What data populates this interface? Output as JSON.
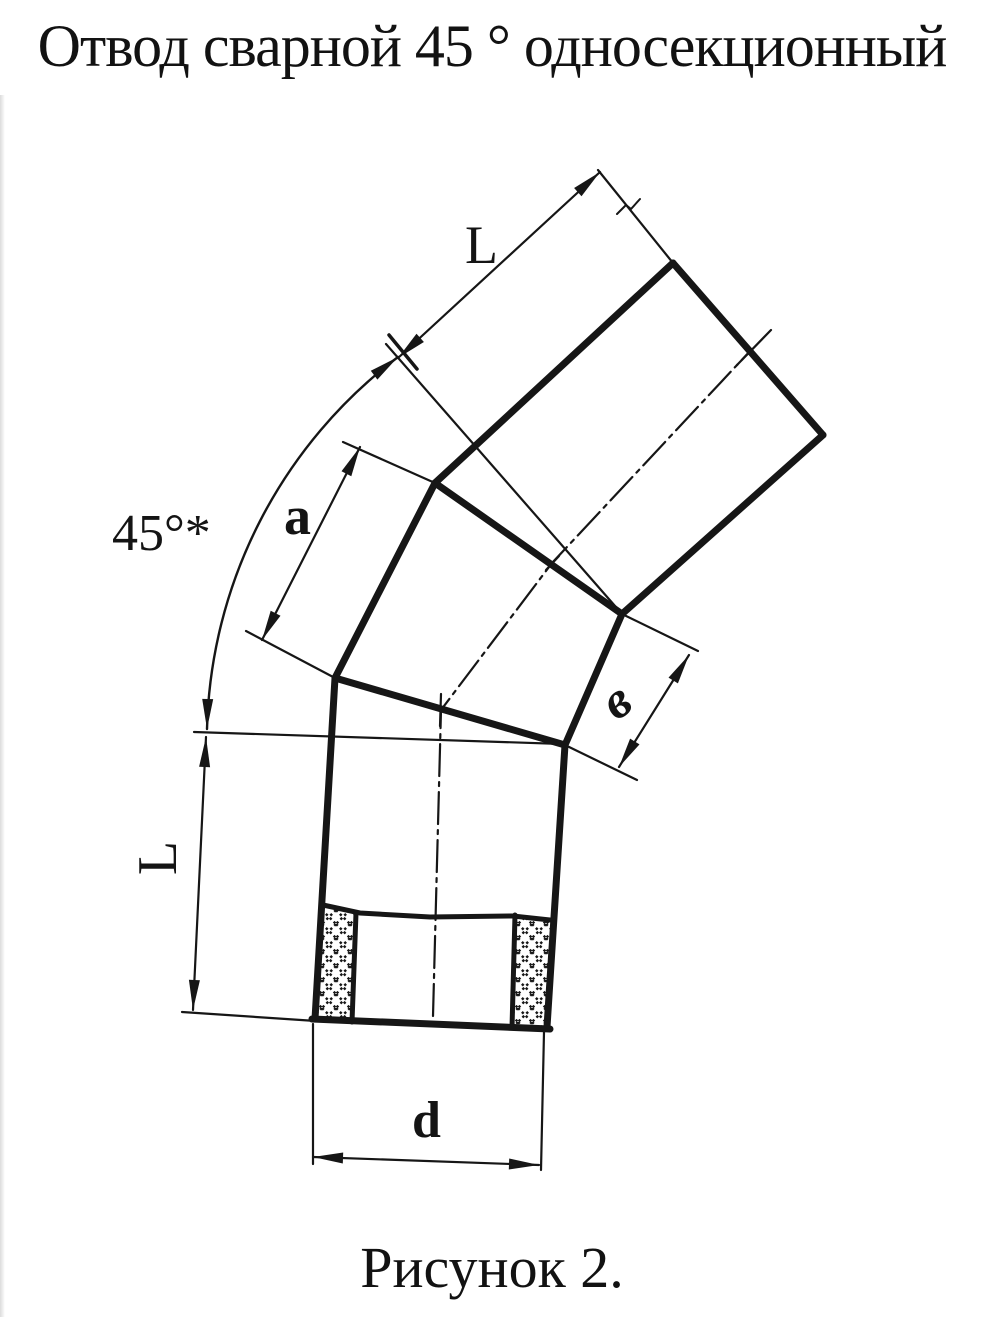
{
  "page": {
    "title": "Отвод сварной 45 ° односекционный",
    "caption": "Рисунок 2."
  },
  "colors": {
    "paper": "#ffffff",
    "ink": "#161616"
  },
  "dimension_labels": {
    "top_length": "L",
    "angle": "45°*",
    "segment_side": "a",
    "segment_end": "в",
    "left_length": "L",
    "diameter": "d"
  }
}
